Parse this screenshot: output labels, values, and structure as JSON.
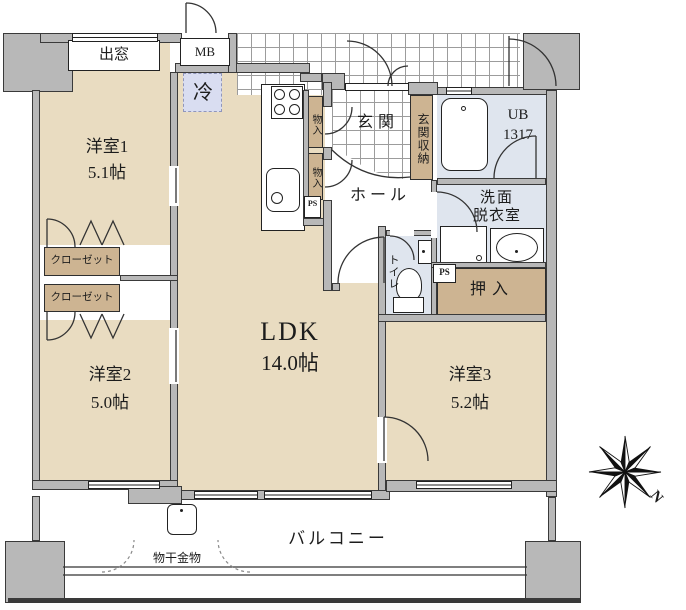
{
  "rooms": {
    "yoshitsu1": {
      "name": "洋室1",
      "size": "5.1帖"
    },
    "yoshitsu2": {
      "name": "洋室2",
      "size": "5.0帖"
    },
    "yoshitsu3": {
      "name": "洋室3",
      "size": "5.2帖"
    },
    "ldk": {
      "name": "LDK",
      "size": "14.0帖"
    },
    "hall": "ホール",
    "genkan": "玄関",
    "toilet": "トイレ",
    "washroom": {
      "line1": "洗面",
      "line2": "脱衣室"
    },
    "bath": {
      "line1": "UB",
      "line2": "1317"
    },
    "balcony": "バルコニー"
  },
  "storage": {
    "genkan_shuno": "玄関収納",
    "oshiire": "押入",
    "closet1": "クローゼット",
    "closet2": "クローゼット",
    "monoire1": "物入",
    "monoire2": "物入"
  },
  "features": {
    "demado": "出窓",
    "mb": "MB",
    "refrigerator": "冷",
    "ps1": "PS",
    "ps2": "PS",
    "monohoshi": "物干金物"
  },
  "compass": {
    "north": "N"
  },
  "colors": {
    "room_fill": "#e9dcc1",
    "storage_fill": "#cdb492",
    "wall_gray": "#b8b8b8",
    "wet_fill": "#dfe5ee",
    "refrigerator_fill": "#d9ddf1",
    "line": "#2e2e2e"
  }
}
